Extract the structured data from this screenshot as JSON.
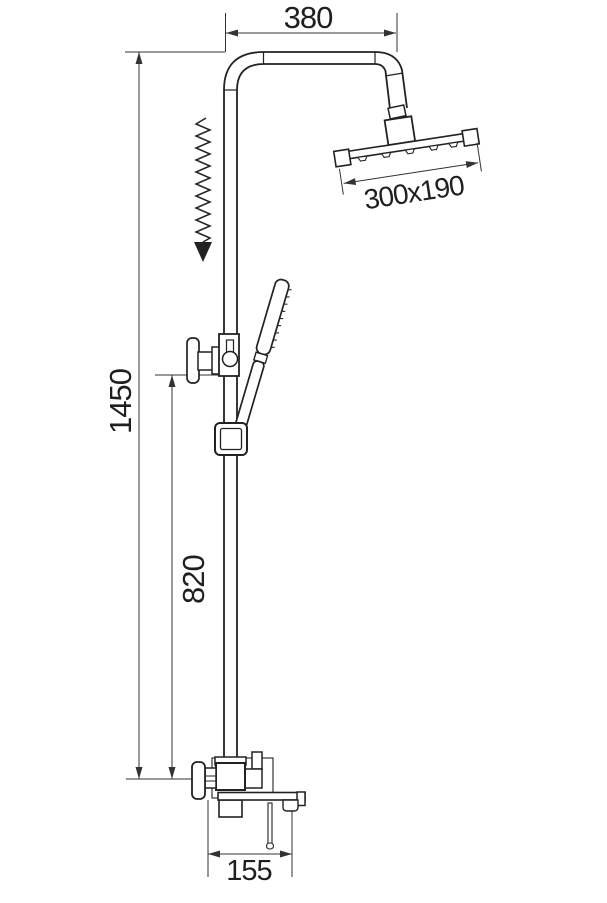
{
  "drawing": {
    "type": "technical-dimension-drawing",
    "subject": "shower-column-set",
    "background_color": "#ffffff",
    "line_color": "#222222",
    "dimension_color": "#333333",
    "labels": {
      "top_width": "380",
      "head_size": "300x190",
      "total_height": "1450",
      "slider_height": "820",
      "spout_width": "155"
    },
    "components": [
      "riser-pipe",
      "rain-shower-head",
      "ball-joint",
      "hand-shower",
      "slider-bracket",
      "hand-shower-holder",
      "height-adjust-arrow",
      "mixer-valve",
      "bath-spout",
      "pull-rod"
    ]
  }
}
